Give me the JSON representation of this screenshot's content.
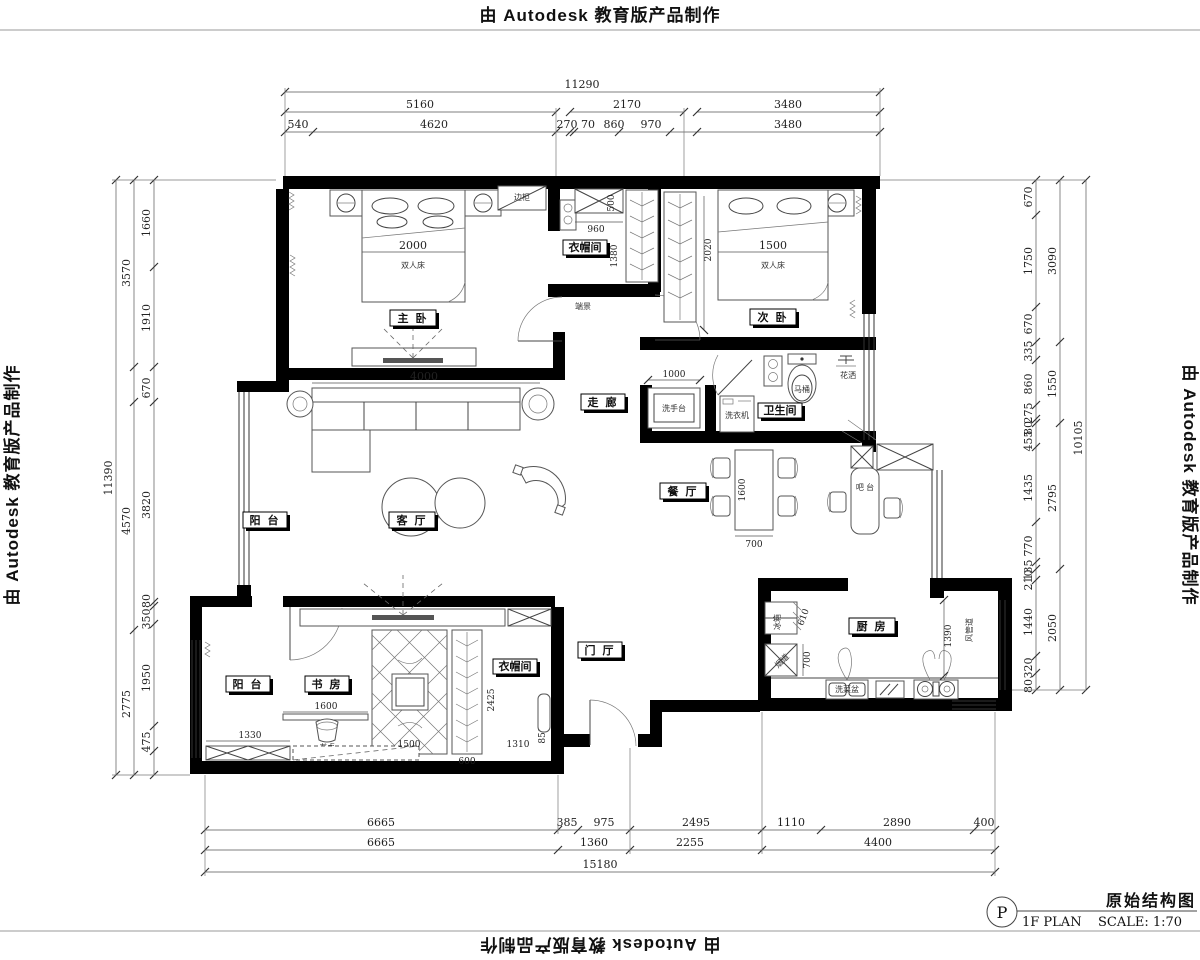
{
  "stamp": {
    "text": "由 Autodesk 教育版产品制作"
  },
  "title_block": {
    "drawing_title": "原始结构图",
    "plan_label": "1F PLAN",
    "scale_label": "SCALE: 1:70",
    "mark": "P"
  },
  "rooms": {
    "master_bedroom": "主 卧",
    "second_bedroom": "次 卧",
    "living_room": "客 厅",
    "dining_room": "餐 厅",
    "corridor": "走 廊",
    "bathroom": "卫生间",
    "kitchen": "厨 房",
    "study": "书 房",
    "balcony_living": "阳 台",
    "balcony_study": "阳 台",
    "cloakroom_top": "衣帽间",
    "cloakroom_bottom": "衣帽间",
    "foyer": "门 厅"
  },
  "furniture": {
    "double_bed_master": "双人床",
    "double_bed_second": "双人床",
    "toilet": "马桶",
    "shower": "花洒",
    "washing_machine": "洗衣机",
    "vanity": "洗手台",
    "bar_counter": "吧 台",
    "sink": "洗菜盆",
    "fridge": "冰箱",
    "flue": "烟道",
    "desk": "书桌",
    "end_feature": "端景",
    "side_cabinet": "边柜",
    "duct": "风管道"
  },
  "dims": {
    "top_total": "11290",
    "top_row2": [
      "5160",
      "2170",
      "3480"
    ],
    "top_row3": [
      "540",
      "4620",
      "270",
      "70",
      "860",
      "970",
      "3480"
    ],
    "bottom_row1": [
      "6665",
      "385",
      "975",
      "2495",
      "1110",
      "2890",
      "400"
    ],
    "bottom_row2": [
      "6665",
      "1360",
      "2255",
      "4400"
    ],
    "bottom_total": "15180",
    "left_total": "11390",
    "left_row2": [
      "3570",
      "4570",
      "2775"
    ],
    "left_row3": [
      "1660",
      "1910",
      "670",
      "3820",
      "80",
      "350",
      "1950",
      "475"
    ],
    "right_total": "10105",
    "right_row2": [
      "3090",
      "1550",
      "2795",
      "2050"
    ],
    "right_row3": [
      "670",
      "1750",
      "670",
      "335",
      "860",
      "275",
      "80",
      "455",
      "1435",
      "770",
      "135",
      "210",
      "1440",
      "320",
      "80"
    ],
    "inner": {
      "master_bed": "2000",
      "second_bed": "1500",
      "sofa_wall": "4000",
      "closet_width": "960",
      "closet_depth": "1380",
      "closet_side": "500",
      "second_wardrobe": "2020",
      "vanity": "1000",
      "dining_length": "1600",
      "dining_width": "700",
      "desk": "1600",
      "balcony_study": "1330",
      "tatami": "1500",
      "wardrobe": "600",
      "cloak_bottom": "1310",
      "study_depth": "2425",
      "study_edge": "850",
      "kitchen_depth": "700",
      "fridge": "610",
      "kitchen_width": "1390"
    }
  }
}
